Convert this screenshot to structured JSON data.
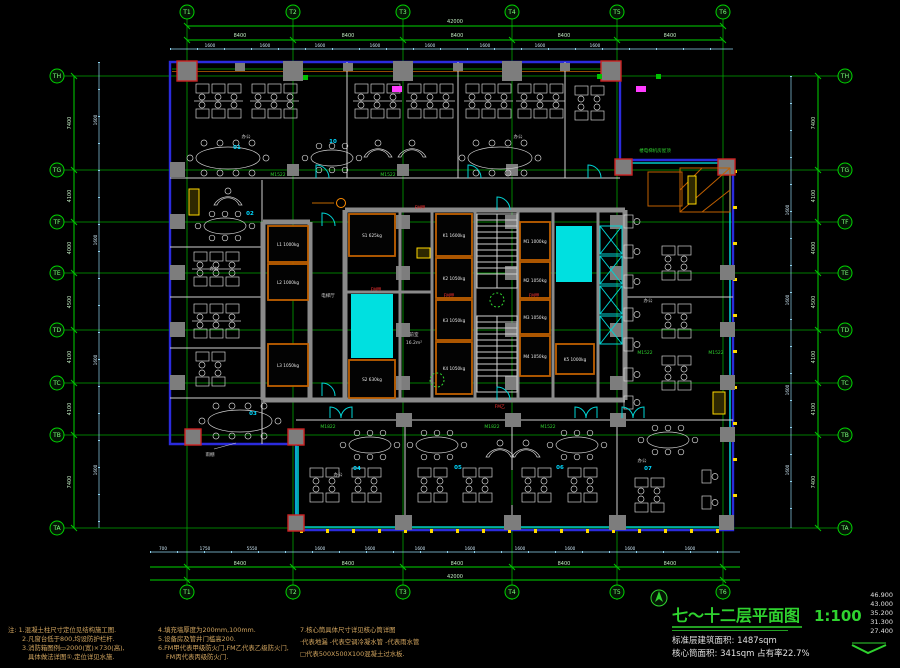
{
  "colors": {
    "grid": "#00a400",
    "dimension": "#8fd4f0",
    "outline_blue": "#2b2bdd",
    "wall_teal": "#00c8c8",
    "wall_white": "#d0d0d0",
    "column_gray": "#7d7d7d",
    "core_gray": "#8a8a8a",
    "lift_orange": "#c06000",
    "shaft_cyan": "#00e0e0",
    "label_green": "#2fd32f",
    "label_cyan": "#00d9ff",
    "label_red": "#ff3434",
    "cabinet_yellow": "#ffd800",
    "tag_magenta": "#ff3cff",
    "notes_tan": "#d2a55f",
    "title_green": "#2fd32f"
  },
  "title_block": {
    "title": "七～十二层平面图",
    "scale": "1:100",
    "area1": "标准层建筑面积: 1487sqm",
    "area2": "核心筒面积: 341sqm 占有率22.7%",
    "elevations": [
      "46.900",
      "43.000",
      "35.200",
      "31.300",
      "27.400"
    ]
  },
  "notes": {
    "col1": [
      "注: 1.混凝土柱尺寸定位见结构施工图.",
      "2.凡窗台低于800,均设防护栏杆.",
      "3.消防箱图例▭2000(宽)×730(高),",
      "具体做法详图①,定位详见水施."
    ],
    "col2": [
      "4.填充墙厚度为200mm,100mm.",
      "5.设备房及管井门槛高200.",
      "6.FM甲代表甲级防火门,FM乙代表乙级防火门,",
      "FM丙代表丙级防火门."
    ],
    "col3": [
      "7.核心筒具体尺寸详见核心筒详图",
      "·代表地漏 -代表空调冷凝水管 -代表雨水管",
      "□代表500X500X100混凝土过水板."
    ]
  },
  "grid": {
    "top": [
      "T1",
      "T2",
      "T3",
      "T4",
      "T5",
      "T6"
    ],
    "left": [
      "TH",
      "TG",
      "TF",
      "TE",
      "TD",
      "TC",
      "TB",
      "TA"
    ]
  },
  "dims": {
    "bay": "8400",
    "total": "42000",
    "win": "1600",
    "seg1": "700",
    "seg2": "1750",
    "seg3": "5550",
    "left": [
      "7400",
      "4100",
      "4000",
      "4500",
      "4100",
      "4100",
      "7400"
    ]
  },
  "core": {
    "lifts": [
      "L1 1000kg",
      "L2 1000kg",
      "L3 1050kg",
      "S1 625kg",
      "S2 630kg",
      "K1 1600kg",
      "K2 1050kg",
      "K3 1050kg",
      "K4 1050kg",
      "M1 1000kg",
      "M2 1050kg",
      "M3 1050kg",
      "M4 1050kg",
      "K5 1000kg"
    ],
    "lobby": "电梯厅",
    "front_room": "前室",
    "front_area": "16.2m²",
    "fire_door_a": "FM甲",
    "fire_door_b": "FM乙",
    "machine_roof": "楼电梯机房屋顶"
  },
  "labels": {
    "office": "办公",
    "canopy": "雨棚",
    "door_a": "M1522",
    "door_b": "M1822",
    "rooms": [
      "01",
      "10",
      "02",
      "03",
      "04",
      "05",
      "06",
      "07"
    ]
  }
}
